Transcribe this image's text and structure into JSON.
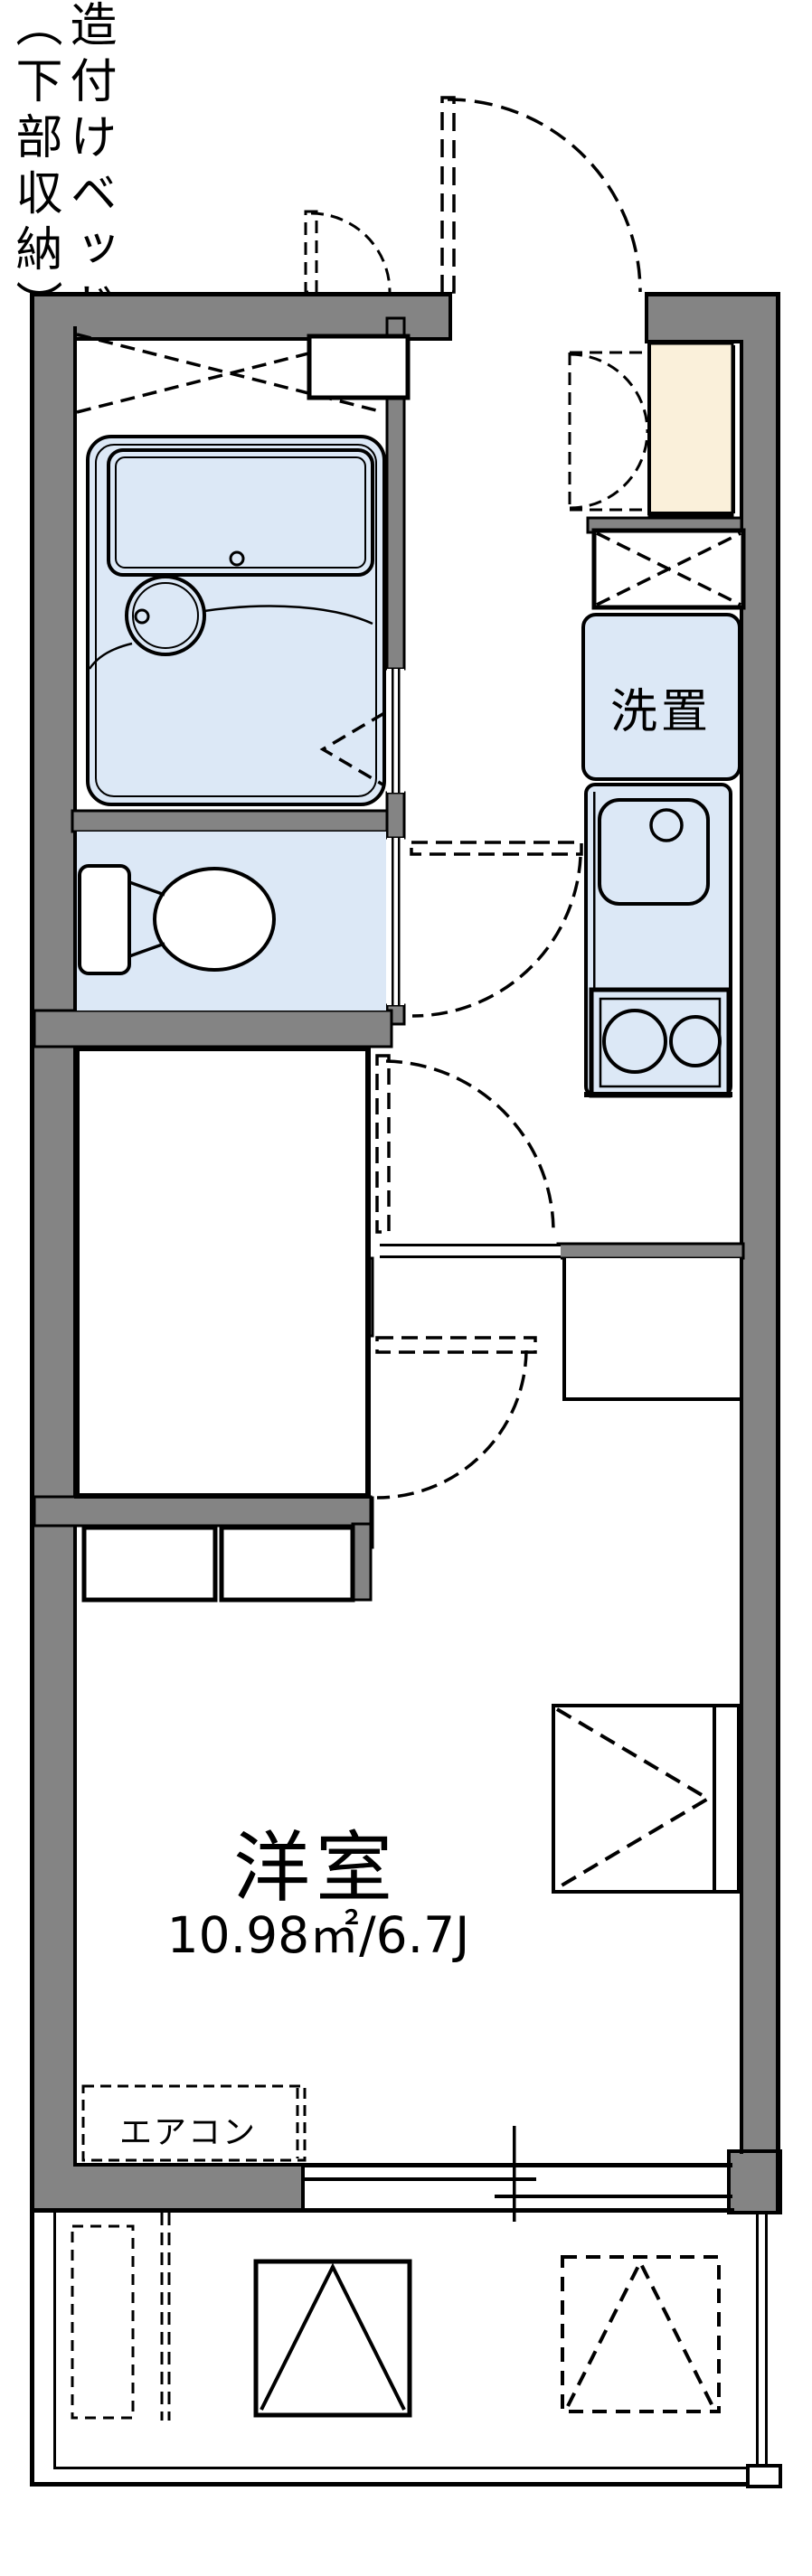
{
  "plan_title": "1K apartment floor plan",
  "colors": {
    "wall": "#848484",
    "outline": "#000000",
    "wet_area_floor": "#dce8f6",
    "entrance_tile": "#faf0da",
    "background": "#ffffff"
  },
  "labels": {
    "washer": "洗置",
    "bed_note_line1": "造付けベッド",
    "bed_note_line2": "（下部収納）",
    "room_name": "洋室",
    "room_size": "10.98㎡/6.7J",
    "aircon": "エアコン"
  },
  "rooms": {
    "western_room": {
      "name": "洋室",
      "area_m2": "10.98",
      "size_jo": "6.7J"
    },
    "bed": {
      "note": "造付けベッド（下部収納）"
    },
    "kitchen": {
      "washer_space": "洗置"
    },
    "living": {
      "aircon_space": "エアコン"
    }
  }
}
